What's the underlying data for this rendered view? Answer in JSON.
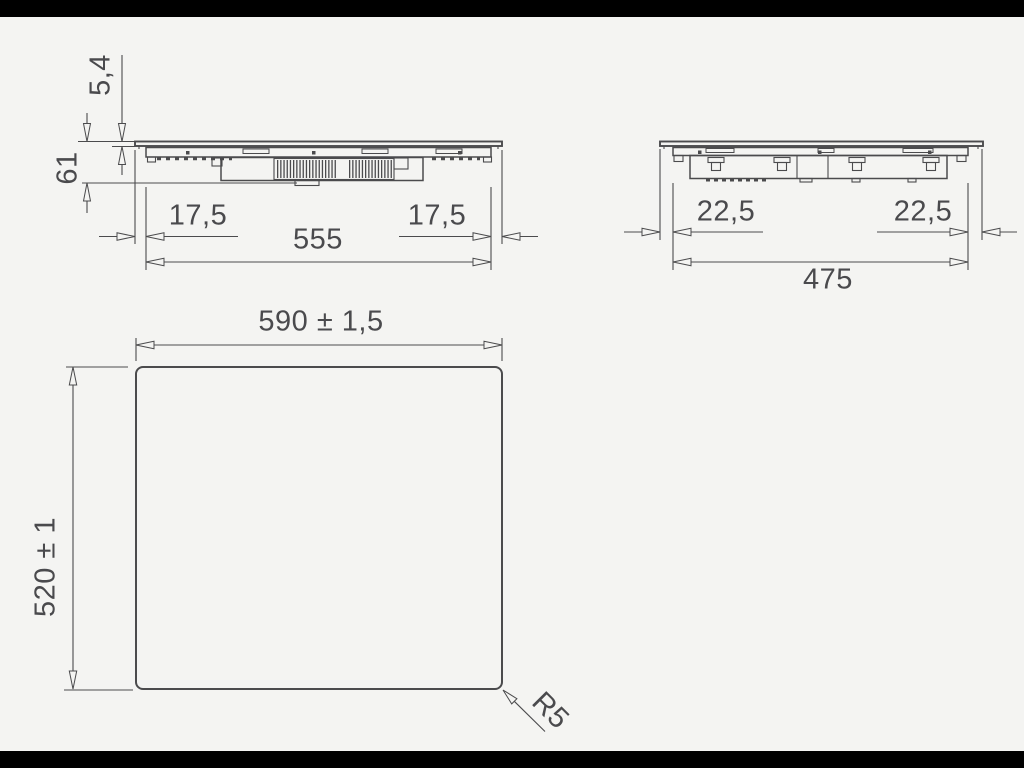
{
  "colors": {
    "background": "#f4f4f2",
    "ink": "#4b4b4d",
    "letterbox": "#000000"
  },
  "drawing": {
    "side_view": {
      "glass_thickness": "5,4",
      "mount_height": "61",
      "left_overhang": "17,5",
      "body_width": "555",
      "right_overhang": "17,5"
    },
    "front_view": {
      "left_overhang": "22,5",
      "body_width": "475",
      "right_overhang": "22,5"
    },
    "cutout_view": {
      "cutout_width": "590 ± 1,5",
      "cutout_height": "520 ± 1",
      "corner_radius": "R5"
    }
  }
}
